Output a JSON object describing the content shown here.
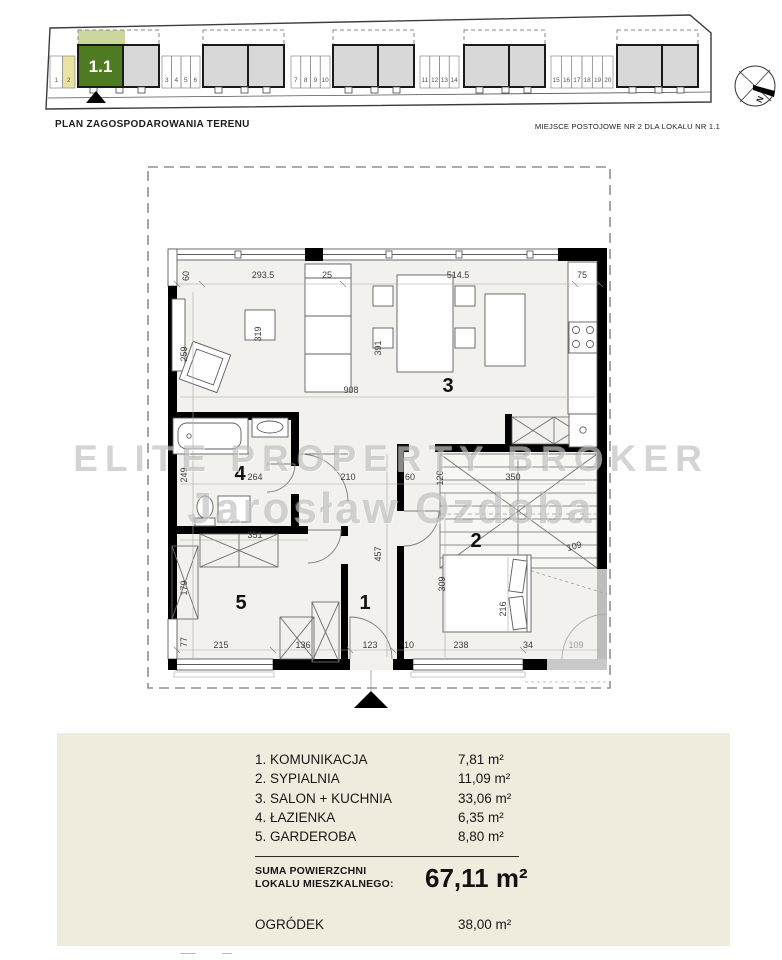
{
  "header": {
    "site_plan_title": "PLAN ZAGOSPODAROWANIA TERENU",
    "parking_note": "MIEJSCE POSTOJOWE NR 2 DLA LOKALU NR 1.1"
  },
  "site_plan": {
    "unit_label": "1.1",
    "compass_label": "N",
    "stall_groups": [
      [
        "1",
        "2"
      ],
      [
        "3",
        "4",
        "5",
        "6"
      ],
      [
        "7",
        "8",
        "9",
        "10"
      ],
      [
        "11",
        "12",
        "13",
        "14"
      ],
      [
        "15",
        "16",
        "17",
        "18",
        "19",
        "20"
      ]
    ],
    "highlighted_stall": "2",
    "colors": {
      "highlight_green": "#4e7b21",
      "garden_green": "#ccd79e",
      "stall_yellow": "#e9e3a2",
      "building_gray": "#d8d8d8"
    }
  },
  "floor_plan": {
    "watermark": {
      "line1": "ELITE PROPERTY BROKER",
      "line2": "Jarosław Ozdoba"
    },
    "room_numbers": [
      {
        "n": "3",
        "x": 303,
        "y": 230
      },
      {
        "n": "4",
        "x": 95,
        "y": 318
      },
      {
        "n": "5",
        "x": 96,
        "y": 447
      },
      {
        "n": "1",
        "x": 220,
        "y": 447
      },
      {
        "n": "2",
        "x": 331,
        "y": 385
      }
    ],
    "dimensions": [
      {
        "t": "60",
        "x": 44,
        "y": 114,
        "r": -90
      },
      {
        "t": "293.5",
        "x": 118,
        "y": 116
      },
      {
        "t": "25",
        "x": 182,
        "y": 116
      },
      {
        "t": "514.5",
        "x": 313,
        "y": 116
      },
      {
        "t": "75",
        "x": 437,
        "y": 116
      },
      {
        "t": "259",
        "x": 42,
        "y": 192,
        "r": -90
      },
      {
        "t": "319",
        "x": 116,
        "y": 172,
        "r": -90
      },
      {
        "t": "391",
        "x": 236,
        "y": 186,
        "r": -90
      },
      {
        "t": "908",
        "x": 206,
        "y": 231
      },
      {
        "t": "249",
        "x": 42,
        "y": 313,
        "r": -90
      },
      {
        "t": "264",
        "x": 110,
        "y": 318
      },
      {
        "t": "210",
        "x": 203,
        "y": 318
      },
      {
        "t": "60",
        "x": 265,
        "y": 318
      },
      {
        "t": "120",
        "x": 298,
        "y": 316,
        "r": -90
      },
      {
        "t": "350",
        "x": 368,
        "y": 318
      },
      {
        "t": "351",
        "x": 110,
        "y": 376
      },
      {
        "t": "457",
        "x": 236,
        "y": 392,
        "r": -90
      },
      {
        "t": "179",
        "x": 42,
        "y": 426,
        "r": -90
      },
      {
        "t": "309",
        "x": 300,
        "y": 422,
        "r": -90
      },
      {
        "t": "216",
        "x": 361,
        "y": 447,
        "r": -90
      },
      {
        "t": "109",
        "x": 430,
        "y": 387,
        "r": -15
      },
      {
        "t": "77",
        "x": 42,
        "y": 480,
        "r": -90
      },
      {
        "t": "215",
        "x": 76,
        "y": 486
      },
      {
        "t": "136",
        "x": 158,
        "y": 486
      },
      {
        "t": "123",
        "x": 225,
        "y": 486
      },
      {
        "t": "10",
        "x": 264,
        "y": 486
      },
      {
        "t": "238",
        "x": 316,
        "y": 486
      },
      {
        "t": "34",
        "x": 383,
        "y": 486
      },
      {
        "t": "109",
        "x": 431,
        "y": 486,
        "c": "gray"
      }
    ]
  },
  "legend": {
    "rooms": [
      {
        "name": "1. KOMUNIKACJA",
        "area": "7,81 m²"
      },
      {
        "name": "2. SYPIALNIA",
        "area": "11,09 m²"
      },
      {
        "name": "3. SALON + KUCHNIA",
        "area": "33,06 m²"
      },
      {
        "name": "4. ŁAZIENKA",
        "area": "6,35 m²"
      },
      {
        "name": "5. GARDEROBA",
        "area": "8,80 m²"
      }
    ],
    "total_label_line1": "SUMA POWIERZCHNI",
    "total_label_line2": "LOKALU MIESZKALNEGO:",
    "total_value": "67,11 m²",
    "garden_label": "OGRÓDEK",
    "garden_value": "38,00 m²"
  }
}
